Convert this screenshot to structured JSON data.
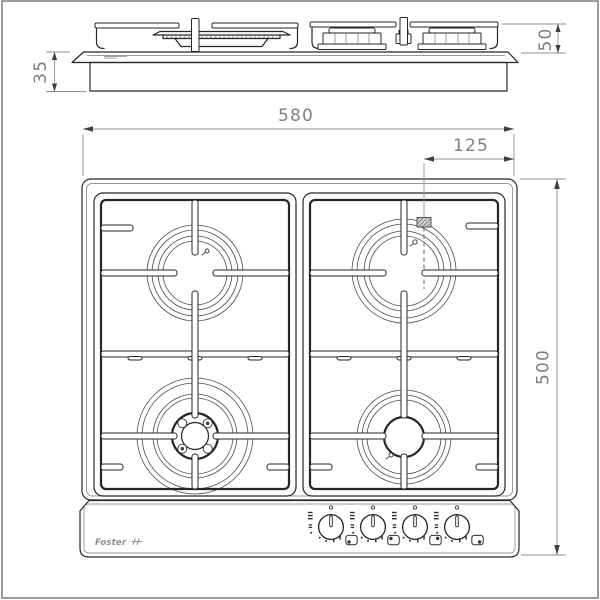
{
  "colors": {
    "object_line": "#262626",
    "thin_line": "#4a4a4a",
    "dim_line": "#8f8f8f",
    "dim_arrow": "#3f3f3f",
    "dim_text": "#7f7f7f",
    "logo_gray": "#8f8f8f",
    "hatch_fill": "#cccccc"
  },
  "dimensions": {
    "top_width": "580",
    "top_right_offset": "125",
    "top_depth": "500",
    "side_height_above": "50",
    "side_recess_below": "35"
  },
  "brand": {
    "logo_text": "Foster"
  },
  "controls": {
    "knob_count": 4,
    "knob_icons": [
      "burner-front-left",
      "burner-rear-left",
      "burner-rear-right",
      "burner-front-right"
    ]
  },
  "icons": {
    "ignition_dot": "ignition-dot-icon",
    "flame_high": "flame-high-icon",
    "flame_low": "flame-low-icon",
    "burner_position": "burner-position-icon",
    "gas_inlet": "gas-inlet-hatch-icon"
  }
}
